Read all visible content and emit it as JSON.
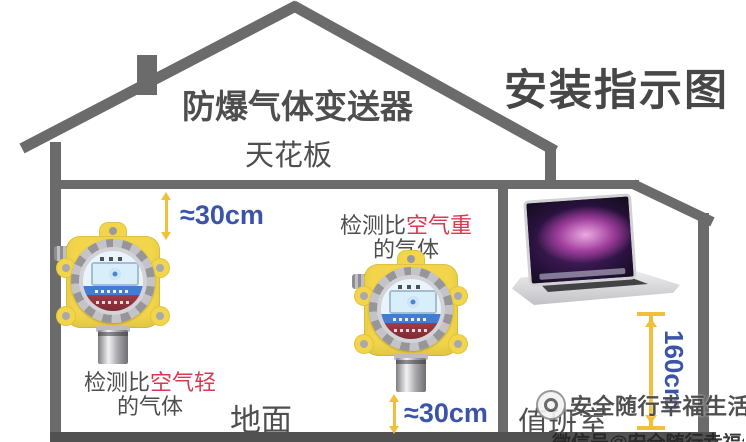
{
  "title": "安装指示图",
  "house": {
    "roof_label": "防爆气体变送器",
    "ceiling_label": "天花板",
    "ground_label": "地面",
    "duty_room_label": "值班室"
  },
  "measurements": {
    "ceiling_gap": "≈30cm",
    "floor_gap": "≈30cm",
    "duty_room_height": "160cm"
  },
  "detector_notes": {
    "light_gas": {
      "prefix": "检测比",
      "highlight": "空气轻",
      "line2": "的气体"
    },
    "heavy_gas": {
      "prefix": "检测比",
      "highlight": "空气重",
      "line2": "的气体"
    }
  },
  "icons": {
    "detector_left": "explosion-proof-gas-detector",
    "detector_middle": "explosion-proof-gas-detector",
    "laptop": "monitoring-laptop",
    "chimney": "chimney",
    "arrows": "double-headed-distance-arrow"
  },
  "watermark": {
    "brand": "安全随行幸福生活",
    "bottom_partial": "微信号@安全随行幸福生活"
  },
  "colors": {
    "structure": "#6b6b6b",
    "floor": "#515151",
    "text": "#4f4f4f",
    "red": "#d93a53",
    "blue": "#3b53a8",
    "arrow": "#efbf3d",
    "device": "#f2d54a"
  }
}
